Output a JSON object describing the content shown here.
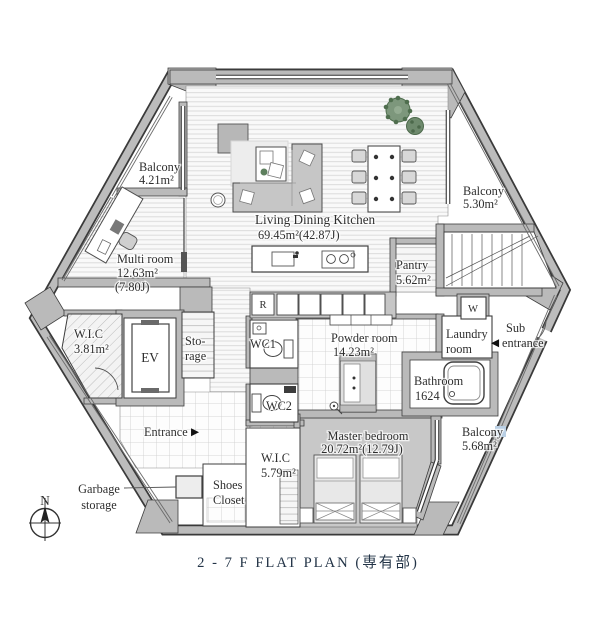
{
  "caption": "2 - 7 F   FLAT PLAN (専有部)",
  "compass": {
    "north_label": "N"
  },
  "rooms": {
    "balcony_tl": {
      "name": "Balcony",
      "area": "4.21m²"
    },
    "balcony_tr": {
      "name": "Balcony",
      "area": "5.30m²"
    },
    "balcony_br": {
      "name": "Balcony",
      "area": "5.68m²"
    },
    "ldk": {
      "name": "Living Dining Kitchen",
      "area": "69.45m²(42.87J)"
    },
    "multi_room": {
      "name": "Multi room",
      "area": "12.63m²",
      "area2": "(7.80J)"
    },
    "pantry": {
      "name": "Pantry",
      "area": "5.62m²"
    },
    "wic_small": {
      "name": "W.I.C",
      "area": "3.81m²"
    },
    "elevator": {
      "name": "EV"
    },
    "storage": {
      "line1": "Sto-",
      "line2": "rage"
    },
    "wc1": {
      "name": "WC1"
    },
    "wc2": {
      "name": "WC2"
    },
    "powder_room": {
      "name": "Powder room",
      "area": "14.23m²"
    },
    "laundry_room": {
      "line1": "Laundry",
      "line2": "room"
    },
    "sub_entrance": {
      "line1": "Sub",
      "line2": "entrance",
      "arrow": "◀"
    },
    "bathroom": {
      "name": "Bathroom",
      "size": "1624"
    },
    "master_bedroom": {
      "name": "Master bedroom",
      "area": "20.72m²(12.79J)"
    },
    "wic_bedroom": {
      "name": "W.I.C",
      "area": "5.79m²"
    },
    "entrance": {
      "name": "Entrance",
      "arrow": "▶"
    },
    "shoes_closet": {
      "line1": "Shoes",
      "line2": "Closet"
    },
    "garbage": {
      "line1": "Garbage",
      "line2": "storage"
    }
  },
  "appliances": {
    "refrigerator": "R",
    "washer": "W"
  },
  "colors": {
    "wall": "#bababa",
    "outline": "#3a3a3a",
    "bedroom_floor": "#c8c8c8",
    "plant": "#7d977c",
    "caption_text": "#233447",
    "balcony_mark": "#b9cfe4"
  }
}
